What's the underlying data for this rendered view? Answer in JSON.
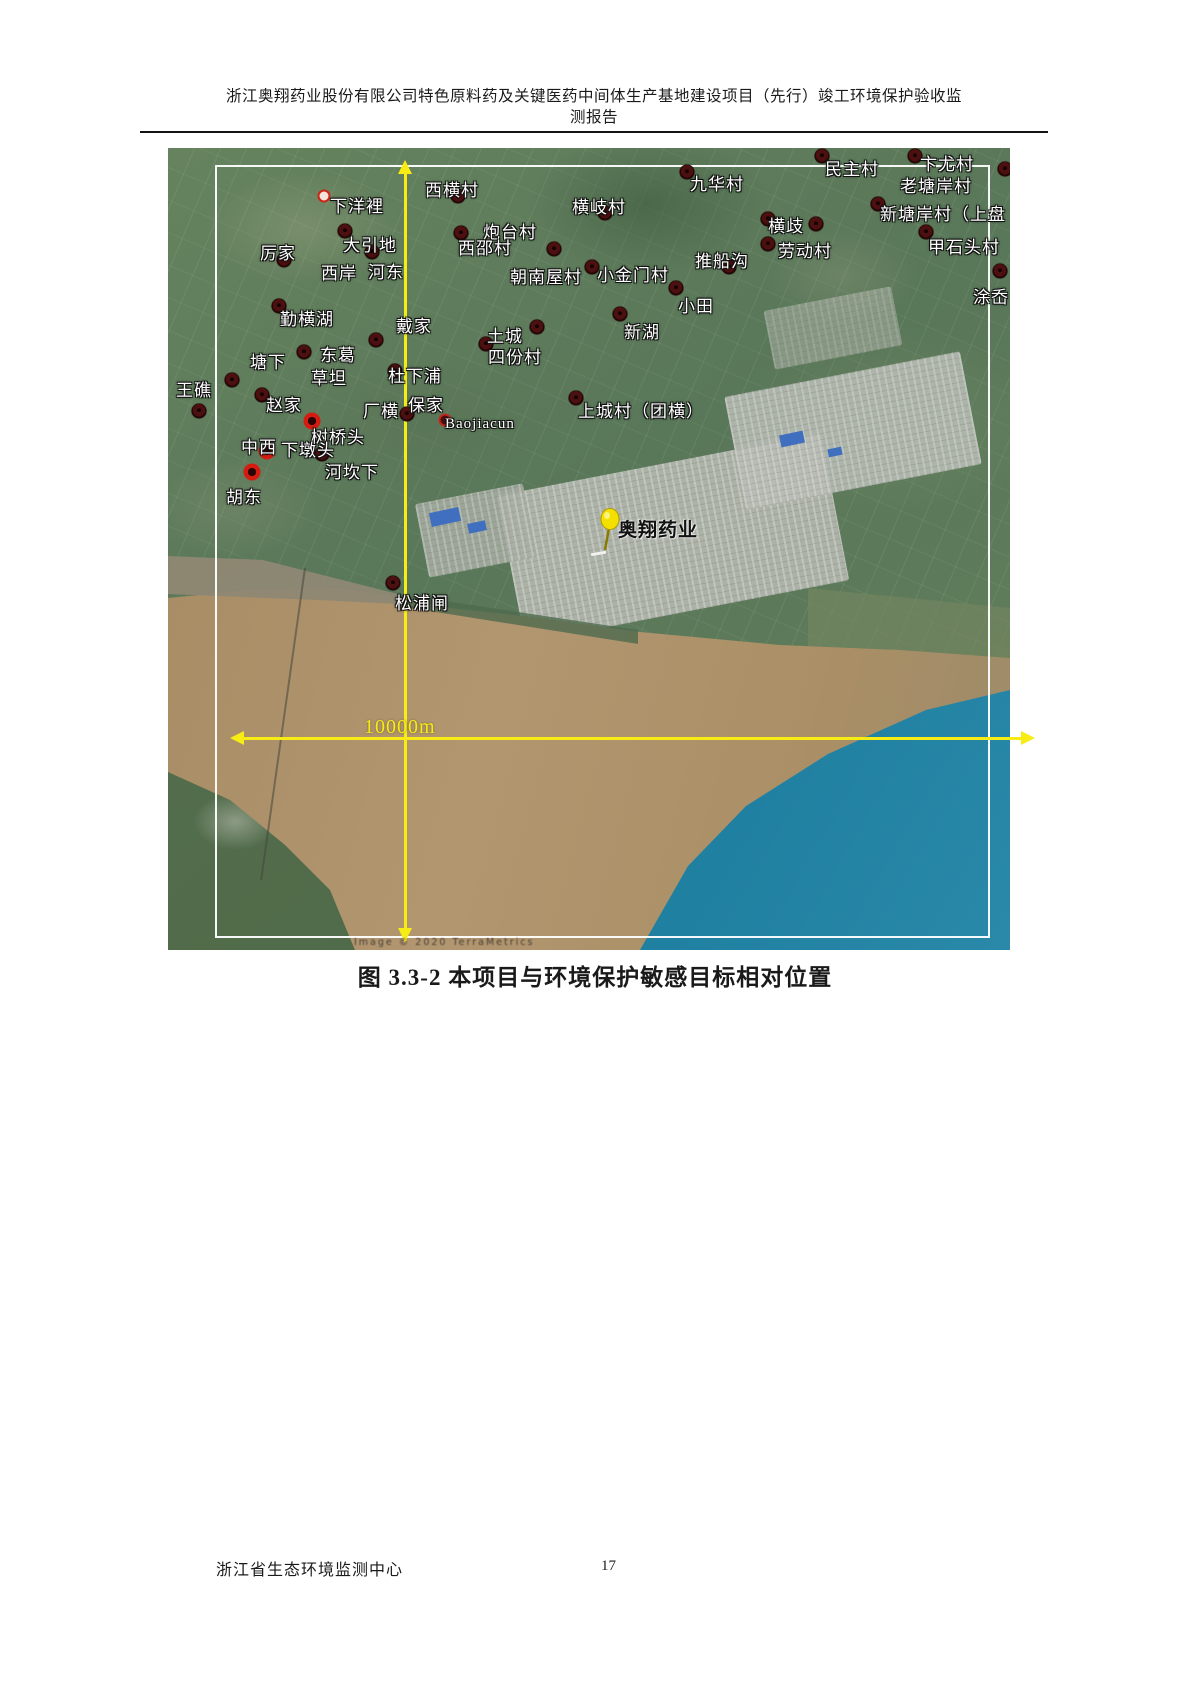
{
  "page": {
    "header_line1": "浙江奥翔药业股份有限公司特色原料药及关键医药中间体生产基地建设项目（先行）竣工环境保护验收监",
    "header_line2": "测报告",
    "caption": "图 3.3-2  本项目与环境保护敏感目标相对位置",
    "footer_left": "浙江省生态环境监测中心",
    "page_number": "17"
  },
  "map": {
    "scale_label": "10000m",
    "attribution": "Image © 2020 TerraMetrics",
    "colors": {
      "accent_yellow": "#f7ec13",
      "marker_dark": "#3b0b0b",
      "marker_red_ring": "#d41c10",
      "river_brown": "#ab9169",
      "sea_blue": "#2b89a5",
      "farmland_green": "#5e7b5e",
      "border_white": "#ffffff"
    },
    "pin": {
      "x": 428,
      "y": 360
    },
    "labels": [
      {
        "text": "下洋裡",
        "x": 162,
        "y": 44
      },
      {
        "text": "西横村",
        "x": 257,
        "y": 28
      },
      {
        "text": "厉家",
        "x": 92,
        "y": 91
      },
      {
        "text": "大引地",
        "x": 175,
        "y": 83
      },
      {
        "text": "西岸",
        "x": 153,
        "y": 111
      },
      {
        "text": "河东",
        "x": 200,
        "y": 110
      },
      {
        "text": "炮台村",
        "x": 315,
        "y": 70
      },
      {
        "text": "西邵村",
        "x": 290,
        "y": 86
      },
      {
        "text": "横岐村",
        "x": 404,
        "y": 45
      },
      {
        "text": "九华村",
        "x": 522,
        "y": 22
      },
      {
        "text": "民主村",
        "x": 657,
        "y": 7
      },
      {
        "text": "卞尤村",
        "x": 752,
        "y": 2
      },
      {
        "text": "老塘岸村",
        "x": 732,
        "y": 24
      },
      {
        "text": "新塘岸村（上盘",
        "x": 712,
        "y": 52
      },
      {
        "text": "甲石头村",
        "x": 760,
        "y": 85
      },
      {
        "text": "涂岙",
        "x": 805,
        "y": 135
      },
      {
        "text": "横歧",
        "x": 600,
        "y": 64
      },
      {
        "text": "劳动村",
        "x": 610,
        "y": 89
      },
      {
        "text": "推船沟",
        "x": 527,
        "y": 99
      },
      {
        "text": "朝南屋村",
        "x": 342,
        "y": 115
      },
      {
        "text": "小金门村",
        "x": 429,
        "y": 113
      },
      {
        "text": "小田",
        "x": 510,
        "y": 144
      },
      {
        "text": "新湖",
        "x": 456,
        "y": 170
      },
      {
        "text": "勤横湖",
        "x": 112,
        "y": 157
      },
      {
        "text": "戴家",
        "x": 228,
        "y": 164
      },
      {
        "text": "土城",
        "x": 319,
        "y": 174
      },
      {
        "text": "四份村",
        "x": 320,
        "y": 195
      },
      {
        "text": "塘下",
        "x": 82,
        "y": 200
      },
      {
        "text": "东葛",
        "x": 152,
        "y": 193
      },
      {
        "text": "草坦",
        "x": 143,
        "y": 216
      },
      {
        "text": "杜下浦",
        "x": 220,
        "y": 214
      },
      {
        "text": "王礁",
        "x": 8,
        "y": 228
      },
      {
        "text": "赵家",
        "x": 98,
        "y": 243
      },
      {
        "text": "厂横",
        "x": 195,
        "y": 249
      },
      {
        "text": "保家",
        "x": 240,
        "y": 243
      },
      {
        "text": "上城村（团横）",
        "x": 410,
        "y": 249
      },
      {
        "text": "Baojiacun",
        "x": 277,
        "y": 268,
        "size": 15
      },
      {
        "text": "树桥头",
        "x": 143,
        "y": 275
      },
      {
        "text": "中西",
        "x": 73,
        "y": 285
      },
      {
        "text": "下墩头",
        "x": 113,
        "y": 288
      },
      {
        "text": "河坎下",
        "x": 157,
        "y": 310
      },
      {
        "text": "胡东",
        "x": 58,
        "y": 335
      },
      {
        "text": "松浦闸",
        "x": 227,
        "y": 441
      },
      {
        "text": "奥翔药业",
        "x": 450,
        "y": 367,
        "size": 19,
        "style": "dark"
      }
    ],
    "markers": [
      {
        "x": 290,
        "y": 48,
        "type": "dark"
      },
      {
        "x": 293,
        "y": 85,
        "type": "dark"
      },
      {
        "x": 177,
        "y": 83,
        "type": "dark"
      },
      {
        "x": 204,
        "y": 104,
        "type": "dark"
      },
      {
        "x": 116,
        "y": 112,
        "type": "dark"
      },
      {
        "x": 111,
        "y": 158,
        "type": "dark"
      },
      {
        "x": 437,
        "y": 65,
        "type": "dark"
      },
      {
        "x": 519,
        "y": 24,
        "type": "dark"
      },
      {
        "x": 654,
        "y": 8,
        "type": "dark"
      },
      {
        "x": 747,
        "y": 8,
        "type": "dark"
      },
      {
        "x": 837,
        "y": 21,
        "type": "dark"
      },
      {
        "x": 600,
        "y": 71,
        "type": "dark"
      },
      {
        "x": 648,
        "y": 76,
        "type": "dark"
      },
      {
        "x": 600,
        "y": 96,
        "type": "dark"
      },
      {
        "x": 561,
        "y": 119,
        "type": "dark"
      },
      {
        "x": 386,
        "y": 101,
        "type": "dark"
      },
      {
        "x": 424,
        "y": 119,
        "type": "dark"
      },
      {
        "x": 508,
        "y": 140,
        "type": "dark"
      },
      {
        "x": 452,
        "y": 166,
        "type": "dark"
      },
      {
        "x": 710,
        "y": 56,
        "type": "dark"
      },
      {
        "x": 758,
        "y": 84,
        "type": "dark"
      },
      {
        "x": 832,
        "y": 123,
        "type": "dark"
      },
      {
        "x": 369,
        "y": 179,
        "type": "dark"
      },
      {
        "x": 318,
        "y": 196,
        "type": "dark"
      },
      {
        "x": 136,
        "y": 204,
        "type": "dark"
      },
      {
        "x": 208,
        "y": 192,
        "type": "dark"
      },
      {
        "x": 64,
        "y": 232,
        "type": "dark"
      },
      {
        "x": 31,
        "y": 263,
        "type": "dark"
      },
      {
        "x": 94,
        "y": 247,
        "type": "dark"
      },
      {
        "x": 239,
        "y": 266,
        "type": "dark"
      },
      {
        "x": 227,
        "y": 223,
        "type": "dark"
      },
      {
        "x": 154,
        "y": 306,
        "type": "dark"
      },
      {
        "x": 225,
        "y": 435,
        "type": "dark"
      },
      {
        "x": 408,
        "y": 250,
        "type": "dark"
      },
      {
        "x": 144,
        "y": 273,
        "type": "red"
      },
      {
        "x": 99,
        "y": 303,
        "type": "red"
      },
      {
        "x": 84,
        "y": 324,
        "type": "red"
      },
      {
        "x": 156,
        "y": 48,
        "type": "smallred"
      },
      {
        "x": 277,
        "y": 272,
        "type": "poi"
      }
    ]
  }
}
